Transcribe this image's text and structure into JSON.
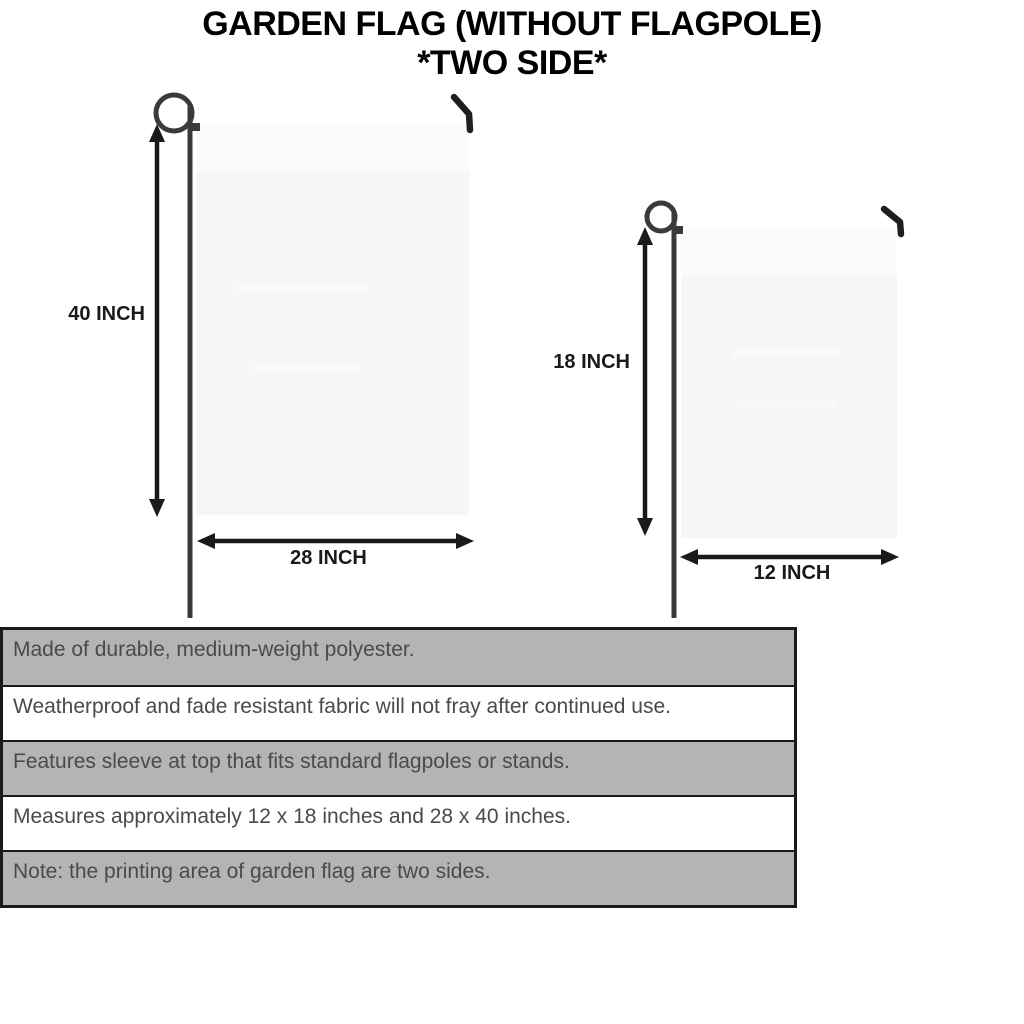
{
  "title": {
    "line1": "GARDEN FLAG (WITHOUT FLAGPOLE)",
    "line2": "*TWO SIDE*"
  },
  "diagram": {
    "large_flag": {
      "height_label": "40 INCH",
      "width_label": "28 INCH"
    },
    "small_flag": {
      "height_label": "18 INCH",
      "width_label": "12 INCH"
    }
  },
  "features": {
    "rows": [
      {
        "text": "Made of durable, medium-weight polyester.",
        "shaded": true
      },
      {
        "text": "Weatherproof and fade resistant fabric will not fray after continued use.",
        "shaded": false
      },
      {
        "text": "Features sleeve at top that fits standard flagpoles or stands.",
        "shaded": true
      },
      {
        "text": "Measures approximately 12 x 18 inches and 28 x 40 inches.",
        "shaded": false
      },
      {
        "text": "Note: the printing area of garden flag are two sides.",
        "shaded": true
      }
    ]
  },
  "colors": {
    "background": "#ffffff",
    "title_text": "#000000",
    "dimension_text": "#1a1a1a",
    "flag_fill": "#f6f6f5",
    "pole": "#3c3a37",
    "hook": "#1f1f1f",
    "arrow": "#1a1a1a",
    "table_shaded_row": "#b4b4b4",
    "table_white_row": "#ffffff",
    "table_border": "#1a1a1a",
    "table_text": "#4a4a4a"
  }
}
